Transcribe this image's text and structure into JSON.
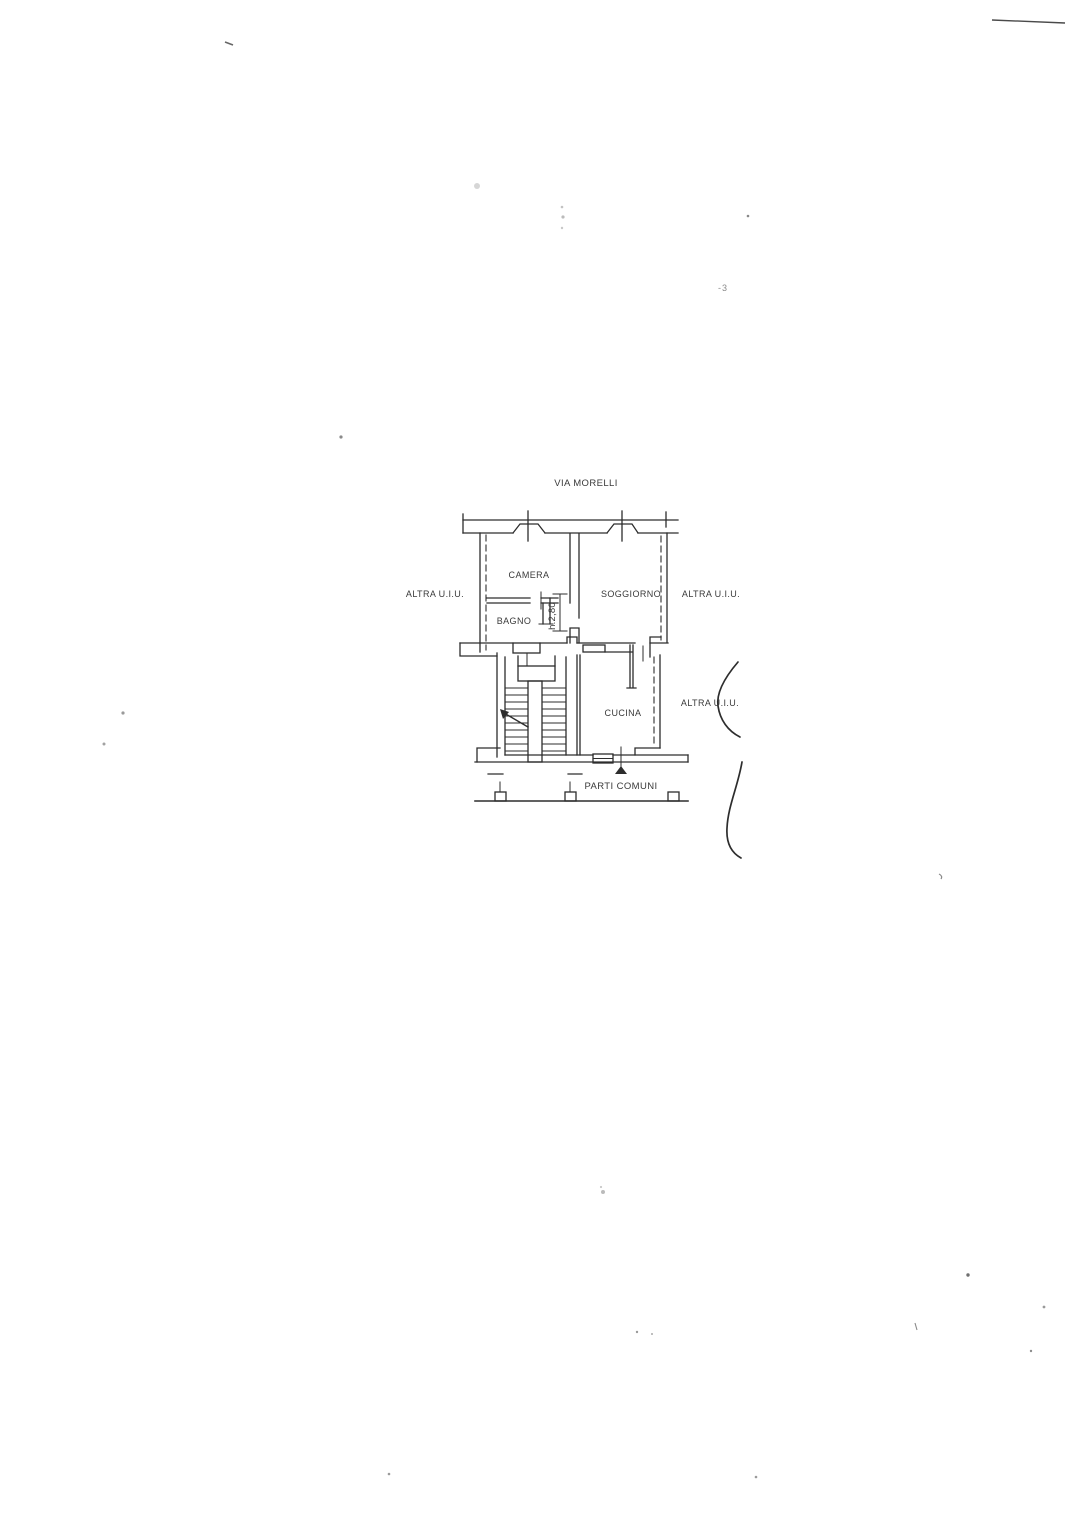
{
  "floorplan": {
    "street_label": "VIA MORELLI",
    "room_labels": {
      "camera": "CAMERA",
      "soggiorno": "SOGGIORNO",
      "bagno": "BAGNO",
      "cucina": "CUCINA"
    },
    "adjacent_unit_labels": {
      "left": "ALTRA U.I.U.",
      "right_top": "ALTRA U.I.U.",
      "right_middle": "ALTRA U.I.U."
    },
    "common_parts_label": "PARTI COMUNI",
    "height_dimension": "h.2,80",
    "handwritten_mark": "-3",
    "ink_color": "#2d2d2d",
    "text_color": "#3a3a3a",
    "faint_mark_color": "#8a8a8a",
    "paper_color": "#ffffff"
  }
}
